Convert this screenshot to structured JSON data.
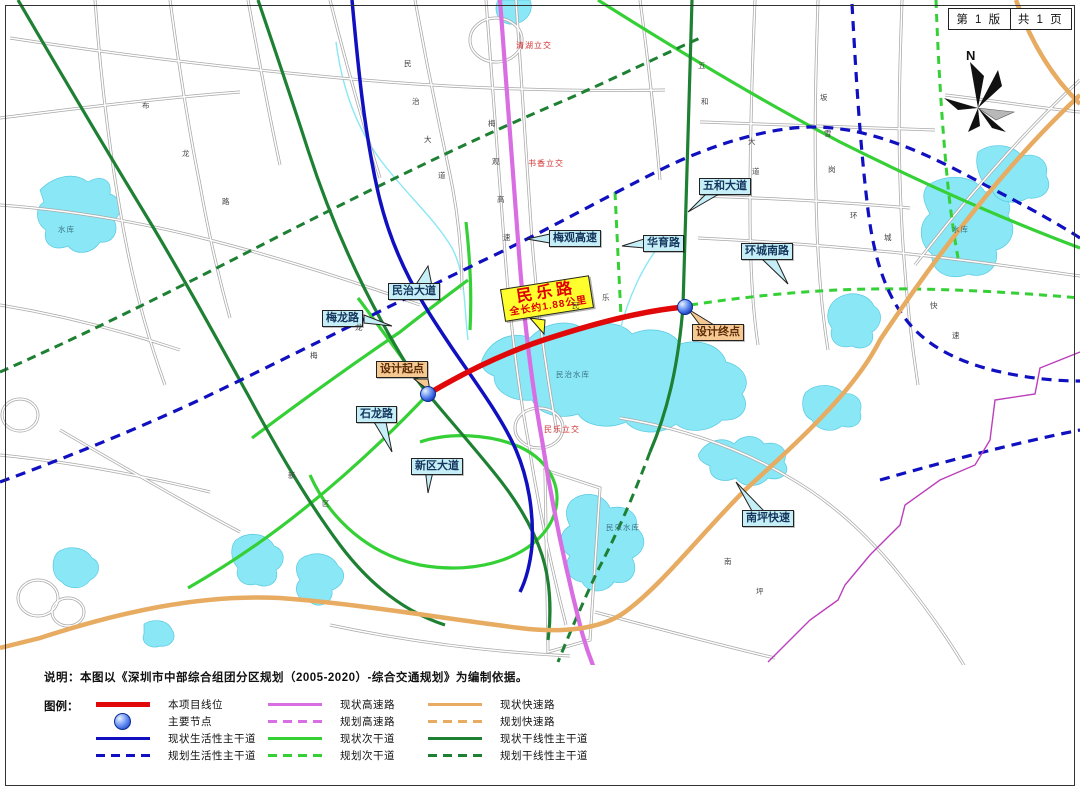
{
  "titleblock": {
    "edition": "第 1 版",
    "pages": "共 1 页"
  },
  "compass": {
    "label": "N"
  },
  "project": {
    "name": "民乐路",
    "length_note": "全长约1.88公里"
  },
  "callouts": {
    "minzhi_dadao": "民治大道",
    "meilong_lu": "梅龙路",
    "meiguan_gaosu": "梅观高速",
    "huayu_lu": "华育路",
    "huancheng_nanlu": "环城南路",
    "wuhe_dadao": "五和大道",
    "shilong_lu": "石龙路",
    "xinqu_dadao": "新区大道",
    "nanping_kuaisu": "南坪快速",
    "design_start": "设计起点",
    "design_end": "设计终点"
  },
  "small_labels": {
    "interchanges": [
      "清湖立交",
      "书香立交",
      "民乐立交"
    ],
    "reservoirs": [
      "民治水库",
      "民乐水库",
      "水库",
      "水库"
    ]
  },
  "map": {
    "scatter": [
      {
        "t": "民",
        "x": 404,
        "y": 58
      },
      {
        "t": "治",
        "x": 412,
        "y": 96
      },
      {
        "t": "大",
        "x": 424,
        "y": 134
      },
      {
        "t": "道",
        "x": 438,
        "y": 170
      },
      {
        "t": "梅",
        "x": 488,
        "y": 118
      },
      {
        "t": "观",
        "x": 492,
        "y": 156
      },
      {
        "t": "高",
        "x": 497,
        "y": 194
      },
      {
        "t": "速",
        "x": 503,
        "y": 232
      },
      {
        "t": "五",
        "x": 698,
        "y": 60
      },
      {
        "t": "和",
        "x": 701,
        "y": 96
      },
      {
        "t": "大",
        "x": 748,
        "y": 136
      },
      {
        "t": "道",
        "x": 752,
        "y": 166
      },
      {
        "t": "布",
        "x": 142,
        "y": 100
      },
      {
        "t": "龙",
        "x": 182,
        "y": 148
      },
      {
        "t": "路",
        "x": 222,
        "y": 196
      },
      {
        "t": "环",
        "x": 850,
        "y": 210
      },
      {
        "t": "城",
        "x": 884,
        "y": 232
      },
      {
        "t": "坂",
        "x": 820,
        "y": 92
      },
      {
        "t": "雪",
        "x": 824,
        "y": 128
      },
      {
        "t": "岗",
        "x": 828,
        "y": 164
      },
      {
        "t": "新",
        "x": 288,
        "y": 470
      },
      {
        "t": "区",
        "x": 322,
        "y": 498
      },
      {
        "t": "梅",
        "x": 310,
        "y": 350
      },
      {
        "t": "龙",
        "x": 355,
        "y": 322
      },
      {
        "t": "民",
        "x": 572,
        "y": 300
      },
      {
        "t": "乐",
        "x": 602,
        "y": 292
      },
      {
        "t": "南",
        "x": 724,
        "y": 556
      },
      {
        "t": "坪",
        "x": 756,
        "y": 586
      },
      {
        "t": "快",
        "x": 930,
        "y": 300
      },
      {
        "t": "速",
        "x": 952,
        "y": 330
      }
    ]
  },
  "note": "说明：本图以《深圳市中部综合组团分区规划（2005-2020）-综合交通规划》为编制依据。",
  "legend": {
    "title": "图例：",
    "items": [
      {
        "label": "本项目线位"
      },
      {
        "label": "主要节点"
      },
      {
        "label": "现状生活性主干道"
      },
      {
        "label": "规划生活性主干道"
      },
      {
        "label": "现状高速路"
      },
      {
        "label": "规划高速路"
      },
      {
        "label": "现状次干道"
      },
      {
        "label": "规划次干道"
      },
      {
        "label": "现状快速路"
      },
      {
        "label": "规划快速路"
      },
      {
        "label": "现状干线性主干道"
      },
      {
        "label": "规划干线性主干道"
      }
    ]
  },
  "colors": {
    "project_line": "#e00808",
    "node": "#1d46d4",
    "living_arterial": "#1010c0",
    "expressway_hw": "#d96ee2",
    "secondary": "#35d035",
    "fast_road": "#e7ab61",
    "trunk_arterial": "#1d8032",
    "water": "#8ae7f5",
    "callout_bg": "#c6eef6",
    "endpoint_bg": "#f6c992",
    "project_label_bg": "#ffff2e",
    "boundary": "#bb3fbb"
  }
}
